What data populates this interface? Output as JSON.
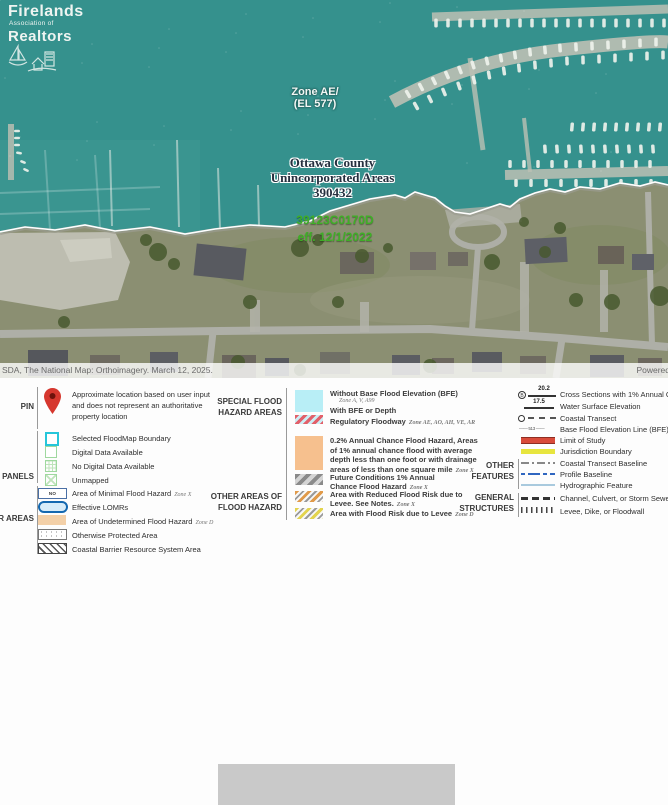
{
  "logo": {
    "name": "Firelands",
    "sub": "Association of",
    "name2": "Realtors"
  },
  "map": {
    "zone_label_1": "Zone AE/",
    "zone_label_2": "(EL 577)",
    "community_1": "Ottawa County",
    "community_2": "Unincorporated Areas",
    "community_3": "390432",
    "panel_1": "39123C0170D",
    "panel_2": "eff. 12/1/2022",
    "attribution": "SDA, The National Map: Orthoimagery. March 12, 2025.",
    "powered": "Powered"
  },
  "legend": {
    "pin_label": "PIN",
    "pin_desc_1": "Approximate location based on user input",
    "pin_desc_2": "and does not represent an authoritative",
    "pin_desc_3": "property location",
    "panels_label": "P PANELS",
    "panels_1": "Selected FloodMap Boundary",
    "panels_2": "Digital Data Available",
    "panels_3": "No Digital Data Available",
    "panels_4": "Unmapped",
    "areas_label": "ER AREAS",
    "noscreen": "NO SCREEN",
    "areas_1": "Area of Minimal Flood Hazard",
    "areas_1_zone": "Zone X",
    "areas_2": "Effective LOMRs",
    "areas_3": "Area of Undetermined Flood Hazard",
    "areas_3_zone": "Zone D",
    "areas_4": "Otherwise Protected Area",
    "areas_5": "Coastal Barrier Resource System Area",
    "sfha_label_1": "SPECIAL FLOOD",
    "sfha_label_2": "HAZARD AREAS",
    "sfha_1": "Without Base Flood Elevation (BFE)",
    "sfha_1_zone": "Zone A, V, A99",
    "sfha_2": "With BFE or Depth",
    "sfha_3": "Regulatory Floodway",
    "sfha_3_zone": "Zone AE, AO, AH, VE, AR",
    "pct_1": "0.2% Annual Chance Flood Hazard, Areas",
    "pct_2": "of 1% annual chance flood with average",
    "pct_3": "depth less than one foot or with drainage",
    "pct_4": "areas of less than one square mile",
    "pct_zone": "Zone X",
    "oafh_label_1": "OTHER AREAS OF",
    "oafh_label_2": "FLOOD HAZARD",
    "future_1": "Future Conditions 1% Annual",
    "future_2": "Chance Flood Hazard",
    "future_zone": "Zone X",
    "levee_1": "Area with Reduced Flood Risk due to",
    "levee_2": "Levee. See Notes.",
    "levee_zone": "Zone X",
    "levee2_1": "Area with Flood Risk due to Levee",
    "levee2_zone": "Zone D",
    "of_label_1": "OTHER",
    "of_label_2": "FEATURES",
    "cross_value": "20.2",
    "cross_text": "Cross Sections with 1% Annual Chan",
    "wse_value": "17.5",
    "wse_text": "Water Surface Elevation",
    "transect_text": "Coastal Transect",
    "bfe_value": "513",
    "bfe_text": "Base Flood Elevation Line (BFE)",
    "limit_text": "Limit of Study",
    "jurisdiction_text": "Jurisdiction Boundary",
    "baseline_text": "Coastal Transect Baseline",
    "profile_text": "Profile Baseline",
    "hydro_text": "Hydrographic Feature",
    "gs_label_1": "GENERAL",
    "gs_label_2": "STRUCTURES",
    "channel_text": "Channel, Culvert, or Storm Sewer",
    "levee_dike_text": "Levee, Dike, or Floodwall"
  },
  "colors": {
    "water": "#35918d",
    "land": "#8b8f72",
    "sfha_fill": "#b8eef6",
    "floodway_red": "#e2606a",
    "orange_02": "#f6c08e",
    "undetermined_tan": "#f3d0a8",
    "limit_red": "#d94b3a",
    "jurisdiction_yellow": "#e7e53e",
    "profile_blue": "#2f66c0",
    "hydro_blue": "#a9cade",
    "panel_green": "#3fae27",
    "pin_red": "#d6372e",
    "select_cyan": "#26c6da",
    "digital_green": "#9fd89f"
  }
}
